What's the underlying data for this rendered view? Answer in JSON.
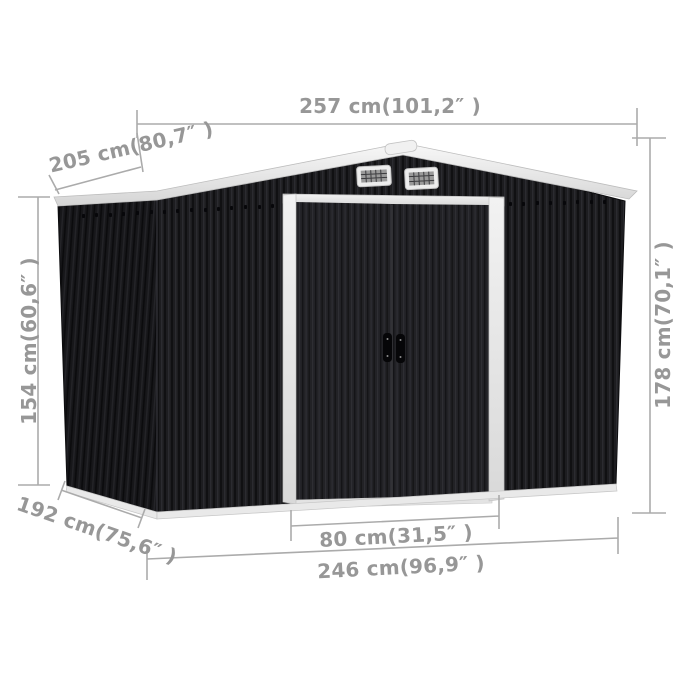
{
  "diagram": {
    "type": "product-dimension-diagram",
    "subject": "anthracite metal garden storage shed with sliding double doors",
    "background": "#ffffff",
    "colors": {
      "shed_front": "#1d1d20",
      "shed_side": "#161619",
      "roof": "#ececec",
      "trim_white": "#e6e6e6",
      "dimension_gray": "#9a9a9a"
    },
    "labels": {
      "width_top": "257 cm(101,2″ )",
      "roof_depth": "205 cm(80,7″ )",
      "wall_height": "154 cm(60,6″ )",
      "total_height": "178 cm(70,1″ )",
      "base_depth": "192 cm(75,6″ )",
      "door_width": "80 cm(31,5″ )",
      "base_width": "246 cm(96,9″ )"
    }
  }
}
